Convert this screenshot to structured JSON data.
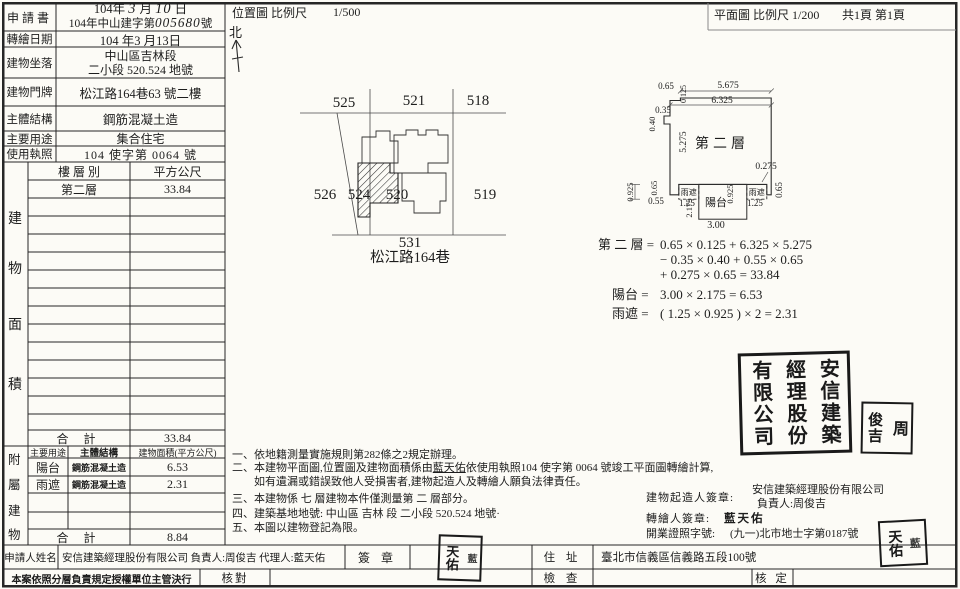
{
  "header": {
    "location_title": "位置圖 比例尺",
    "location_scale": "1/500",
    "north": "北",
    "plan_title": "平面圖 比例尺 1/200",
    "page_info": "共1頁 第1頁"
  },
  "info": {
    "application_label": "申請書",
    "application_date_prefix": "104年",
    "application_date_month": "3",
    "application_date_month_unit": "月",
    "application_date_day": "10",
    "application_date_day_unit": "日",
    "application_no_prefix": "104年中山建字第",
    "application_no_hand": "005680",
    "application_no_suffix": "號",
    "redraw_label": "轉繪日期",
    "redraw_date": "104 年3 月13日",
    "site_label": "建物坐落",
    "site_line1": "中山區吉林段",
    "site_line2": "二小段 520.524 地號",
    "address_label": "建物門牌",
    "address": "松江路164巷63 號二樓",
    "structure_label": "主體結構",
    "structure": "鋼筋混凝土造",
    "usage_label": "主要用途",
    "usage": "集合住宅",
    "license_label": "使用執照",
    "license": "104 使字第 0064 號"
  },
  "floor_table": {
    "side_chars": [
      "建",
      "物",
      "面",
      "積"
    ],
    "col_floor": "樓 層 別",
    "col_area": "平方公尺",
    "row_floor": "第二層",
    "row_area": "33.84",
    "total_label": "合  計",
    "total_area": "33.84"
  },
  "annex_table": {
    "side_chars": [
      "附",
      "屬",
      "建",
      "物"
    ],
    "col_use": "主要用途",
    "col_structure": "主體結構",
    "col_area": "建物面積(平方公尺)",
    "rows": [
      {
        "use": "陽台",
        "structure": "鋼筋混凝土造",
        "area": "6.53"
      },
      {
        "use": "雨遮",
        "structure": "鋼筋混凝土造",
        "area": "2.31"
      }
    ],
    "total_label": "合  計",
    "total_area": "8.84"
  },
  "map": {
    "plots": {
      "p525": "525",
      "p521": "521",
      "p518": "518",
      "p526": "526",
      "p524": "524",
      "p520": "520",
      "p519": "519",
      "p531": "531"
    },
    "street": "松江路164巷"
  },
  "plan": {
    "floor_label": "第二層",
    "balcony": "陽台",
    "canopy_left": "雨遮",
    "canopy_right": "雨遮",
    "dims": {
      "top_left_w": "0.65",
      "top_left_h": "0.125",
      "top_w": "5.675",
      "top_total_w": "6.325",
      "notch_w": "0.35",
      "notch_h": "0.40",
      "left_h": "5.275",
      "right_step_w": "0.275",
      "right_step_h": "0.65",
      "left_canopy_h": "0.925",
      "left_step_h": "0.65",
      "left_step_w": "0.55",
      "left_canopy_w": "1.25",
      "balcony_h": "2.175",
      "right_canopy_h": "0.925",
      "right_canopy_w": "1.25",
      "balcony_w": "3.00"
    }
  },
  "calc": {
    "floor_label": "第 二 層 =",
    "floor_line1": "0.65 × 0.125 + 6.325 × 5.275",
    "floor_line2": "− 0.35 × 0.40 + 0.55 × 0.65",
    "floor_line3": "+ 0.275 × 0.65 = 33.84",
    "balcony_label": "陽台 =",
    "balcony_expr": "3.00 × 2.175 = 6.53",
    "canopy_label": "雨遮 =",
    "canopy_expr": "( 1.25 × 0.925 ) × 2 = 2.31"
  },
  "notes": {
    "n1": "一、依地籍測量實施規則第282條之2規定辦理。",
    "n2_pre": "二、本建物平面圖,位置圖及建物面積係由",
    "n2_name": "藍天佑",
    "n2_post": "依使用執照104 使字第  0064  號竣工平面圖轉繪計算,",
    "n2_cont": "如有遺漏或錯誤致他人受損害者,建物起造人及轉繪人願負法律責任。",
    "n3": "三、本建物係 七 層建物本件僅測量第  二  層部分。",
    "n4": "四、建築基地地號:  中山區 吉林 段 二小段 520.524 地號·",
    "n5": "五、本圖以建物登記為限。"
  },
  "signoff": {
    "builder_label": "建物起造人簽章:",
    "builder_company": "安信建築經理股份有限公司",
    "builder_person": "負責人:周俊吉",
    "drafter_label": "轉繪人簽章:",
    "drafter_name": "藍天佑",
    "license_label": "開業證照字號:",
    "license_no": "(九一)北市地士字第0187號"
  },
  "stamps": {
    "company_cols": [
      "安信建築",
      "經理股份",
      "有限公司"
    ],
    "person_cols": [
      "周",
      "俊吉"
    ],
    "drafter_cols": [
      "藍",
      "天佑"
    ]
  },
  "footer": {
    "applicant_label": "申請人姓名",
    "applicant_value": "安信建築經理股份有限公司 負責人:周俊吉 代理人:藍天佑",
    "sign_label": "簽 章",
    "residence_label": "住 址",
    "residence_value": "臺北市信義區信義路五段100號",
    "delegation": "本案依照分層負責規定授權單位主管決行",
    "check_label": "核對",
    "inspect_label": "檢 查",
    "approve_label": "核 定"
  }
}
